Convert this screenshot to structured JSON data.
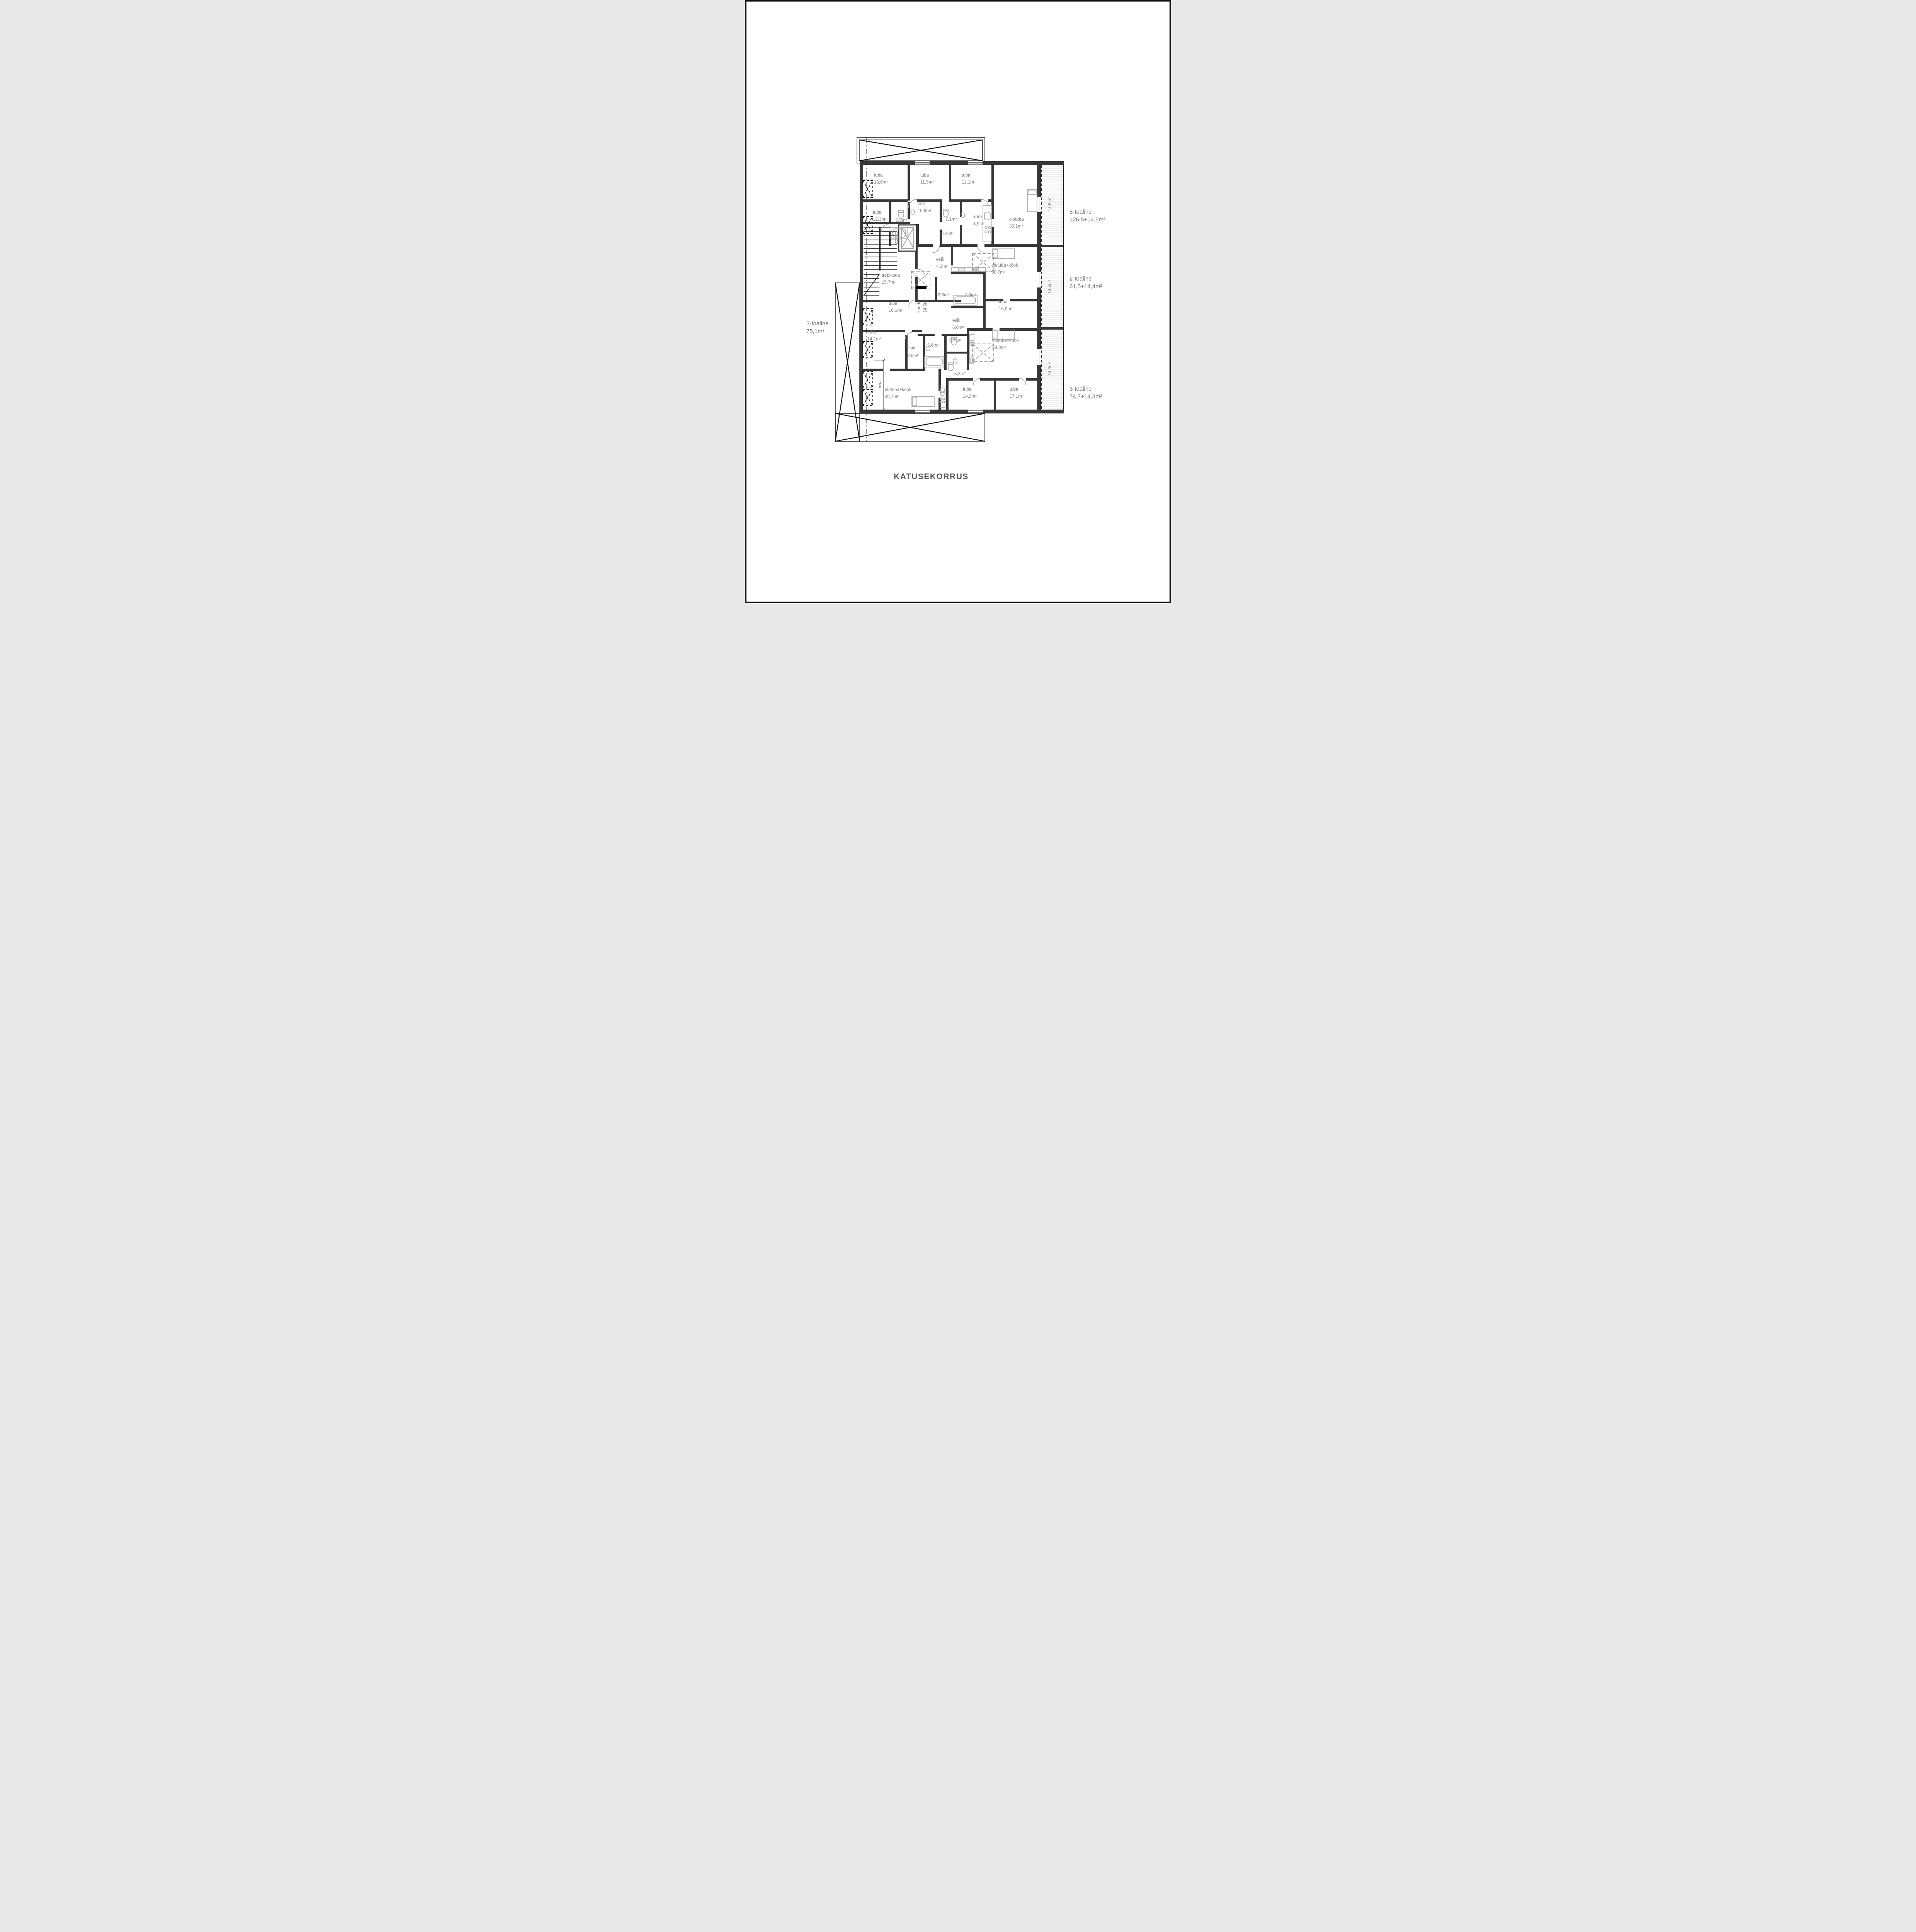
{
  "page": {
    "title": "KATUSEKORRUS"
  },
  "annotations": {
    "right": [
      {
        "name": "5-toaline",
        "area": "126,5+14,5m²"
      },
      {
        "name": "2-toaline",
        "area": "61,5+14,4m²"
      },
      {
        "name": "3-toaline",
        "area": "74,7+14,3m²"
      }
    ],
    "left": {
      "name": "3-toaline",
      "area": "75,1m²"
    }
  },
  "balconies": [
    {
      "area": "14,5m²"
    },
    {
      "area": "14,4m²"
    },
    {
      "area": "14,3m²"
    }
  ],
  "dimension_label": "1826",
  "rooms": {
    "tuba136": {
      "name": "tuba",
      "area": "13,6m²"
    },
    "tuba115": {
      "name": "tuba",
      "area": "11,5m²"
    },
    "tuba121": {
      "name": "tuba",
      "area": "12,1m²"
    },
    "esik169": {
      "name": "esik",
      "area": "16,9m²"
    },
    "tuba123": {
      "name": "tuba",
      "area": "12,3m²"
    },
    "wc56a": {
      "area": "5,6m²"
    },
    "wc71": {
      "area": "7,1m²"
    },
    "kook89": {
      "name": "köök",
      "area": "8,9m²"
    },
    "elutuba351": {
      "name": "elutuba",
      "area": "35,1m²"
    },
    "wc34": {
      "area": "3,4m²"
    },
    "esik43": {
      "name": "esik",
      "area": "4,3m²"
    },
    "ek307a": {
      "name": "elutuba+köök",
      "area": "30,7m²"
    },
    "trepikoda": {
      "name": "trepikoda",
      "area": "15,7m²"
    },
    "koridor": {
      "name": "koridor",
      "area": "14,5m²"
    },
    "wc26": {
      "area": "2,6m²"
    },
    "wc79": {
      "area": "7,9m²"
    },
    "tuba160": {
      "name": "tuba",
      "area": "16,0m²"
    },
    "tuba161": {
      "name": "tuba",
      "area": "16,1m²"
    },
    "esik66": {
      "name": "esik",
      "area": "6,6m²"
    },
    "tuba141": {
      "name": "tuba",
      "area": "14,1m²"
    },
    "wc56b": {
      "area": "5,6m²"
    },
    "wc27": {
      "area": "2,7m²"
    },
    "ek283": {
      "name": "elutuba+köök",
      "area": "28,3m²"
    },
    "esik86": {
      "name": "esik",
      "area": "8,6m²"
    },
    "wc58": {
      "area": "5,8m²"
    },
    "ek307b": {
      "name": "elutuba+köök",
      "area": "30,7m²"
    },
    "tuba142": {
      "name": "tuba",
      "area": "14,2m²"
    },
    "tuba171": {
      "name": "tuba",
      "area": "17,1m²"
    }
  }
}
